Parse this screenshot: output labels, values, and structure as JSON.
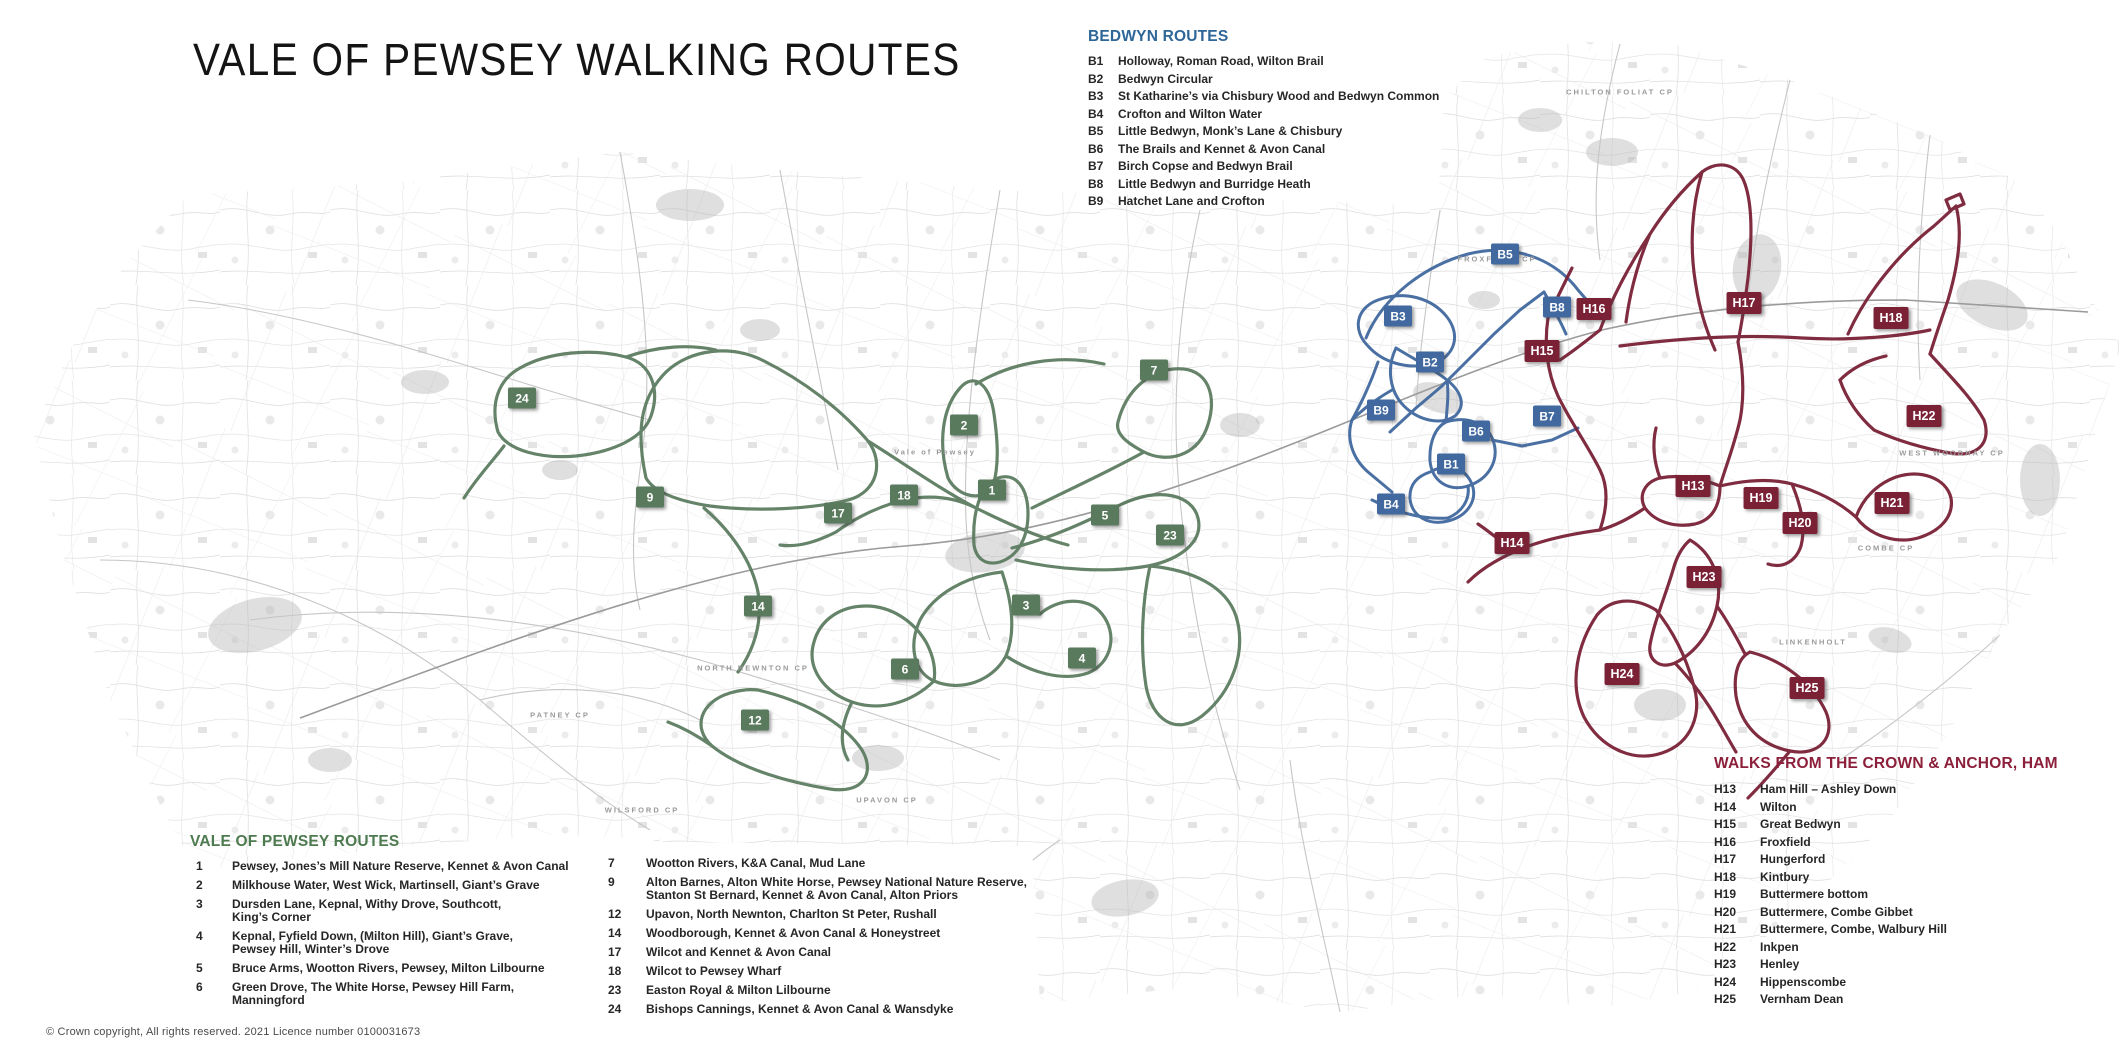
{
  "title": "VALE OF PEWSEY WALKING ROUTES",
  "copyright": "© Crown copyright, All rights reserved. 2021 Licence number 0100031673",
  "colors": {
    "green": "#5a7a5e",
    "blue": "#41699f",
    "maroon": "#7a2136",
    "green_heading": "#4e7a50",
    "blue_heading": "#2d6697",
    "maroon_heading": "#8c1f3a"
  },
  "legends": {
    "bedwyn": {
      "heading": "BEDWYN ROUTES",
      "items": [
        {
          "code": "B1",
          "name": "Holloway, Roman Road, Wilton Brail"
        },
        {
          "code": "B2",
          "name": "Bedwyn Circular"
        },
        {
          "code": "B3",
          "name": "St Katharine’s via Chisbury Wood and Bedwyn Common"
        },
        {
          "code": "B4",
          "name": "Crofton and Wilton Water"
        },
        {
          "code": "B5",
          "name": "Little Bedwyn, Monk’s Lane & Chisbury"
        },
        {
          "code": "B6",
          "name": "The Brails and Kennet & Avon Canal"
        },
        {
          "code": "B7",
          "name": "Birch Copse and Bedwyn Brail"
        },
        {
          "code": "B8",
          "name": "Little Bedwyn and Burridge Heath"
        },
        {
          "code": "B9",
          "name": "Hatchet Lane and Crofton"
        }
      ]
    },
    "vale": {
      "heading": "VALE OF PEWSEY ROUTES",
      "col1": [
        {
          "code": "1",
          "name": "Pewsey, Jones’s Mill Nature Reserve, Kennet & Avon Canal"
        },
        {
          "code": "2",
          "name": "Milkhouse Water, West Wick, Martinsell, Giant’s Grave"
        },
        {
          "code": "3",
          "name": "Dursden Lane, Kepnal, Withy Drove, Southcott,\nKing’s Corner"
        },
        {
          "code": "4",
          "name": "Kepnal, Fyfield Down, (Milton Hill), Giant’s Grave,\nPewsey Hill, Winter’s Drove"
        },
        {
          "code": "5",
          "name": "Bruce Arms, Wootton Rivers, Pewsey, Milton Lilbourne"
        },
        {
          "code": "6",
          "name": "Green Drove, The White Horse, Pewsey Hill Farm,\nManningford"
        }
      ],
      "col2": [
        {
          "code": "7",
          "name": "Wootton Rivers, K&A Canal, Mud Lane"
        },
        {
          "code": "9",
          "name": "Alton Barnes, Alton White Horse, Pewsey National Nature Reserve,\nStanton St Bernard, Kennet & Avon Canal, Alton Priors"
        },
        {
          "code": "12",
          "name": "Upavon, North Newnton, Charlton St Peter, Rushall"
        },
        {
          "code": "14",
          "name": "Woodborough, Kennet & Avon Canal & Honeystreet"
        },
        {
          "code": "17",
          "name": "Wilcot and Kennet & Avon Canal"
        },
        {
          "code": "18",
          "name": "Wilcot to Pewsey Wharf"
        },
        {
          "code": "23",
          "name": "Easton Royal & Milton Lilbourne"
        },
        {
          "code": "24",
          "name": "Bishops Cannings, Kennet & Avon Canal & Wansdyke"
        }
      ]
    },
    "ham": {
      "heading": "WALKS FROM THE CROWN & ANCHOR, HAM",
      "items": [
        {
          "code": "H13",
          "name": "Ham Hill – Ashley Down"
        },
        {
          "code": "H14",
          "name": "Wilton"
        },
        {
          "code": "H15",
          "name": "Great Bedwyn"
        },
        {
          "code": "H16",
          "name": "Froxfield"
        },
        {
          "code": "H17",
          "name": "Hungerford"
        },
        {
          "code": "H18",
          "name": "Kintbury"
        },
        {
          "code": "H19",
          "name": "Buttermere bottom"
        },
        {
          "code": "H20",
          "name": "Buttermere, Combe Gibbet"
        },
        {
          "code": "H21",
          "name": "Buttermere, Combe, Walbury Hill"
        },
        {
          "code": "H22",
          "name": "Inkpen"
        },
        {
          "code": "H23",
          "name": "Henley"
        },
        {
          "code": "H24",
          "name": "Hippenscombe"
        },
        {
          "code": "H25",
          "name": "Vernham Dean"
        }
      ]
    }
  },
  "map": {
    "labels": [
      {
        "text": "Vale of Pewsey",
        "x": 935,
        "y": 452
      },
      {
        "text": "FROXFIELD CP",
        "x": 1497,
        "y": 259
      },
      {
        "text": "CHILTON FOLIAT CP",
        "x": 1620,
        "y": 92
      },
      {
        "text": "COMBE CP",
        "x": 1886,
        "y": 548
      },
      {
        "text": "WEST WOODHAY CP",
        "x": 1952,
        "y": 453
      },
      {
        "text": "LINKENHOLT",
        "x": 1813,
        "y": 642
      },
      {
        "text": "UPAVON CP",
        "x": 887,
        "y": 800
      },
      {
        "text": "NORTH NEWNTON CP",
        "x": 753,
        "y": 668
      },
      {
        "text": "WILSFORD CP",
        "x": 642,
        "y": 810
      },
      {
        "text": "PATNEY CP",
        "x": 560,
        "y": 715
      }
    ],
    "markers": [
      {
        "label": "24",
        "color": "green",
        "x": 522,
        "y": 398
      },
      {
        "label": "7",
        "color": "green",
        "x": 1154,
        "y": 370
      },
      {
        "label": "2",
        "color": "green",
        "x": 964,
        "y": 425
      },
      {
        "label": "1",
        "color": "green",
        "x": 992,
        "y": 490
      },
      {
        "label": "18",
        "color": "green",
        "x": 904,
        "y": 495
      },
      {
        "label": "9",
        "color": "green",
        "x": 650,
        "y": 497
      },
      {
        "label": "17",
        "color": "green",
        "x": 838,
        "y": 513
      },
      {
        "label": "5",
        "color": "green",
        "x": 1105,
        "y": 515
      },
      {
        "label": "23",
        "color": "green",
        "x": 1170,
        "y": 535
      },
      {
        "label": "3",
        "color": "green",
        "x": 1026,
        "y": 605
      },
      {
        "label": "14",
        "color": "green",
        "x": 758,
        "y": 606
      },
      {
        "label": "4",
        "color": "green",
        "x": 1082,
        "y": 658
      },
      {
        "label": "6",
        "color": "green",
        "x": 905,
        "y": 669
      },
      {
        "label": "12",
        "color": "green",
        "x": 755,
        "y": 720
      },
      {
        "label": "B5",
        "color": "blue",
        "x": 1505,
        "y": 254
      },
      {
        "label": "B8",
        "color": "blue",
        "x": 1557,
        "y": 307
      },
      {
        "label": "B3",
        "color": "blue",
        "x": 1398,
        "y": 316
      },
      {
        "label": "B2",
        "color": "blue",
        "x": 1430,
        "y": 362
      },
      {
        "label": "B9",
        "color": "blue",
        "x": 1381,
        "y": 410
      },
      {
        "label": "B7",
        "color": "blue",
        "x": 1547,
        "y": 416
      },
      {
        "label": "B6",
        "color": "blue",
        "x": 1476,
        "y": 431
      },
      {
        "label": "B1",
        "color": "blue",
        "x": 1451,
        "y": 464
      },
      {
        "label": "B4",
        "color": "blue",
        "x": 1391,
        "y": 504
      },
      {
        "label": "H17",
        "color": "maroon",
        "x": 1744,
        "y": 303
      },
      {
        "label": "H16",
        "color": "maroon",
        "x": 1594,
        "y": 309
      },
      {
        "label": "H18",
        "color": "maroon",
        "x": 1891,
        "y": 318
      },
      {
        "label": "H15",
        "color": "maroon",
        "x": 1542,
        "y": 351
      },
      {
        "label": "H22",
        "color": "maroon",
        "x": 1924,
        "y": 416
      },
      {
        "label": "H13",
        "color": "maroon",
        "x": 1693,
        "y": 486
      },
      {
        "label": "H19",
        "color": "maroon",
        "x": 1761,
        "y": 498
      },
      {
        "label": "H21",
        "color": "maroon",
        "x": 1892,
        "y": 503
      },
      {
        "label": "H20",
        "color": "maroon",
        "x": 1800,
        "y": 523
      },
      {
        "label": "H14",
        "color": "maroon",
        "x": 1512,
        "y": 543
      },
      {
        "label": "H23",
        "color": "maroon",
        "x": 1704,
        "y": 577
      },
      {
        "label": "H24",
        "color": "maroon",
        "x": 1622,
        "y": 674
      },
      {
        "label": "H25",
        "color": "maroon",
        "x": 1807,
        "y": 688
      }
    ]
  }
}
